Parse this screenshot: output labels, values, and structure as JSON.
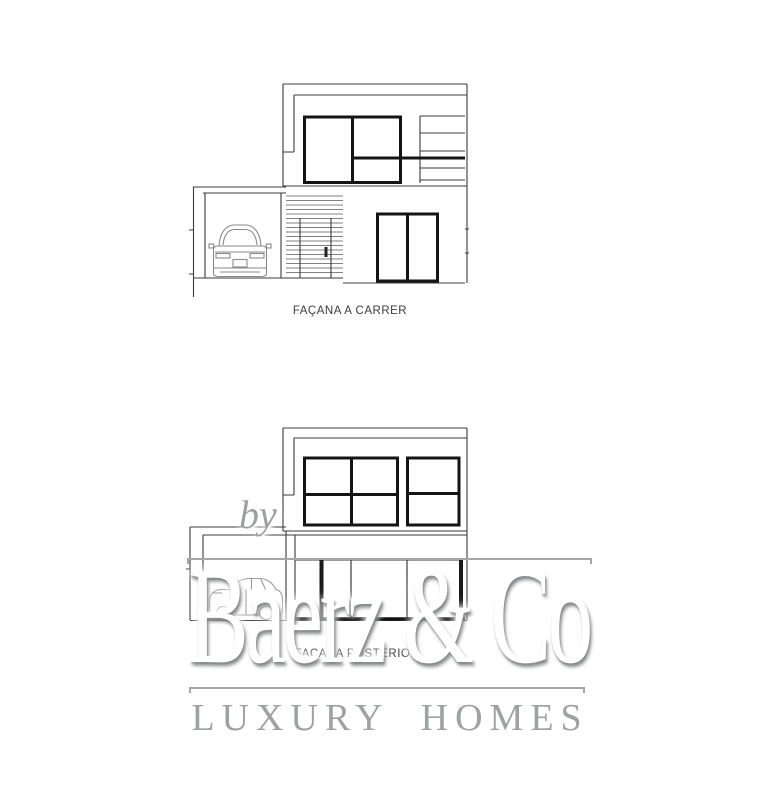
{
  "page": {
    "background": "#ffffff",
    "description": "architectural elevation sheet with two house facades and agency watermark"
  },
  "drawings": {
    "street_facade": {
      "label": "FAÇANA A CARRER"
    },
    "rear_facade": {
      "label": "FAÇANA POSTERIOR"
    }
  },
  "watermark": {
    "prefix": "by",
    "brand": "Baerz & Co",
    "tagline": "LUXURY HOMES",
    "brand_color": "#ffffff",
    "engraved_color": "#9da2a2",
    "rule_color": "#a2a7a7"
  },
  "icons": {
    "car_rear": "car-rear-view",
    "car_side": "car-side-view"
  },
  "drawing_colors": {
    "thin_line": "#3a3a3a",
    "thick_frame": "#141414",
    "car_line": "#8a8a8a"
  }
}
